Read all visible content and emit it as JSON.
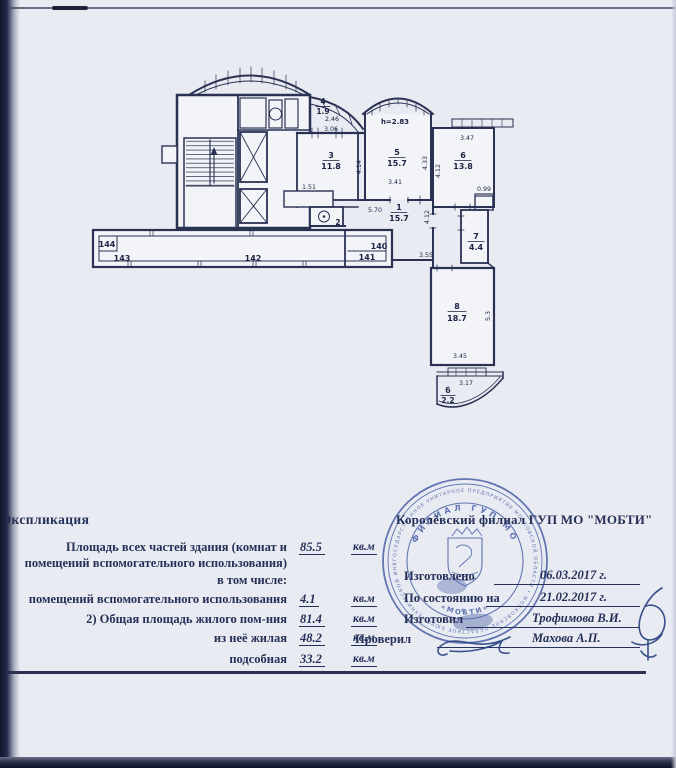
{
  "page": {
    "bg": "#e9ebf2",
    "ink": "#2a3254",
    "text_color": "#253058",
    "stamp_color": "#3b54a0"
  },
  "plan": {
    "height_note": "h=2.83",
    "rooms": {
      "r1": {
        "num": "1",
        "area": "15.7"
      },
      "r2": {
        "num": "2"
      },
      "r3": {
        "num": "3",
        "area": "11.8"
      },
      "r4": {
        "num": "4",
        "area": "1.9"
      },
      "r5": {
        "num": "5",
        "area": "15.7"
      },
      "r6": {
        "num": "6",
        "area": "13.8"
      },
      "r7": {
        "num": "7",
        "area": "4.4"
      },
      "r8": {
        "num": "8",
        "area": "18.7"
      },
      "bal": {
        "num": "б",
        "area": "2.2"
      }
    },
    "dims": {
      "d246": "2.46",
      "d306": "3.06",
      "d151": "1.51",
      "d414": "4.14",
      "d341": "3.41",
      "d433": "4.33",
      "d347": "3.47",
      "d412a": "4.12",
      "d099": "0.99",
      "d570": "5.70",
      "d412b": "4.12",
      "d355": "3.55",
      "d345": "3.45",
      "d53": "5.3",
      "d317": "3.17"
    },
    "gallery": {
      "n144": "144",
      "n143": "143",
      "n142": "142",
      "n141": "141",
      "n140": "140"
    }
  },
  "explication": {
    "title": "Экспликация",
    "unit": "кв.м",
    "row1_line1": "Площадь всех частей здания (комнат и",
    "row1_line2": "помещений вспомогательного использования)",
    "row1_value": "85.5",
    "subhead": "в том числе:",
    "row2_label": "помещений вспомогательного использования",
    "row2_value": "4.1",
    "row3_label": "2) Общая площадь жилого пом-ния",
    "row3_value": "81.4",
    "row4_label": "из неё жилая",
    "row4_value": "48.2",
    "row5_label": "подсобная",
    "row5_value": "33.2"
  },
  "footer": {
    "org": "Королёвский филиал ГУП МО \"МОБТИ\"",
    "made_label": "Изготовлено",
    "made_date": "06.03.2017 г.",
    "asof_label": "По состоянию на",
    "asof_date": "21.02.2017 г.",
    "drafted_label": "Изготовил",
    "drafted_name": "Трофимова В.И.",
    "checked_label": "Проверил",
    "checked_name": "Махова А.П."
  },
  "stamp": {
    "ring_outer": "ГОСУДАРСТВЕННОЕ УНИТАРНОЕ ПРЕДПРИЯТИЕ МОСКОВСКОЙ ОБЛАСТИ • МОСКОВСКОЕ ОБЛАСТНОЕ БЮРО ТЕХНИЧЕСКОЙ ИНВЕНТАРИЗАЦИИ •",
    "ring_inner_top": "ФИЛИАЛ ГУП МО",
    "ring_inner_bottom": "«МОБТИ»",
    "center_mark": "*"
  }
}
